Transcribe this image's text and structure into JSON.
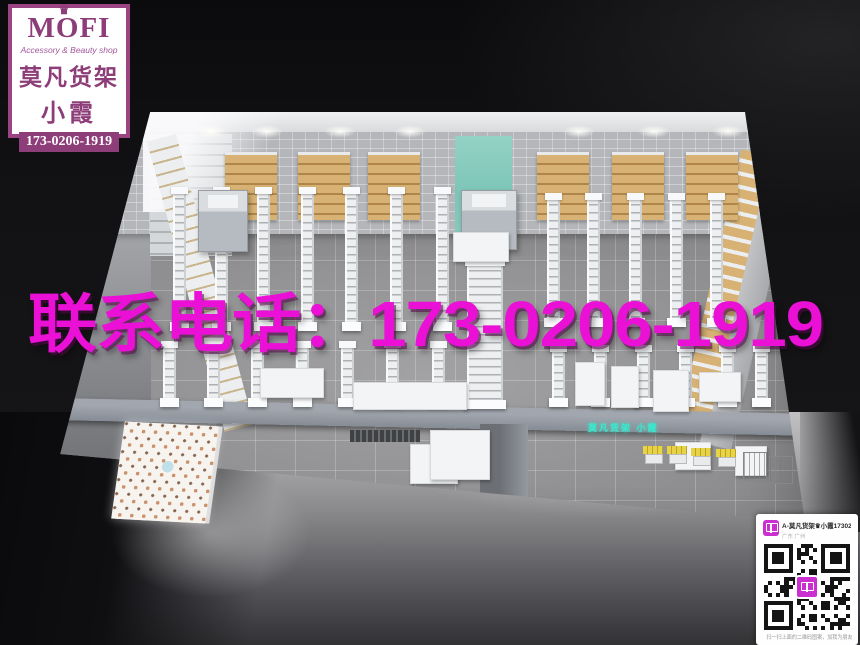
{
  "brand_card": {
    "name": "MOFI",
    "crown_icon": "♛",
    "tagline": "Accessory & Beauty shop",
    "line1": "莫凡货架",
    "line2": "小霞",
    "phone": "173-0206-1919",
    "accent_color": "#8d3d78"
  },
  "watermark": {
    "contact_text": "联系电话：173-0206-1919",
    "color": "#ea10d5"
  },
  "neon_sign": {
    "text": "莫凡货架 小霞",
    "color": "#38e9cd"
  },
  "qr_card": {
    "contact_name": "A-莫凡货架♛小霞173020...",
    "contact_location": "广东 广州",
    "caption": "扫一扫上面的二维码图案，加我为朋友",
    "app_icon_color": "#cb2fd0"
  },
  "scene_colors": {
    "teal_accent_wall": "#85cabe",
    "wood_shelves": "#cfa768",
    "floor_tile": "#9b9b9d",
    "background": "#101012"
  }
}
